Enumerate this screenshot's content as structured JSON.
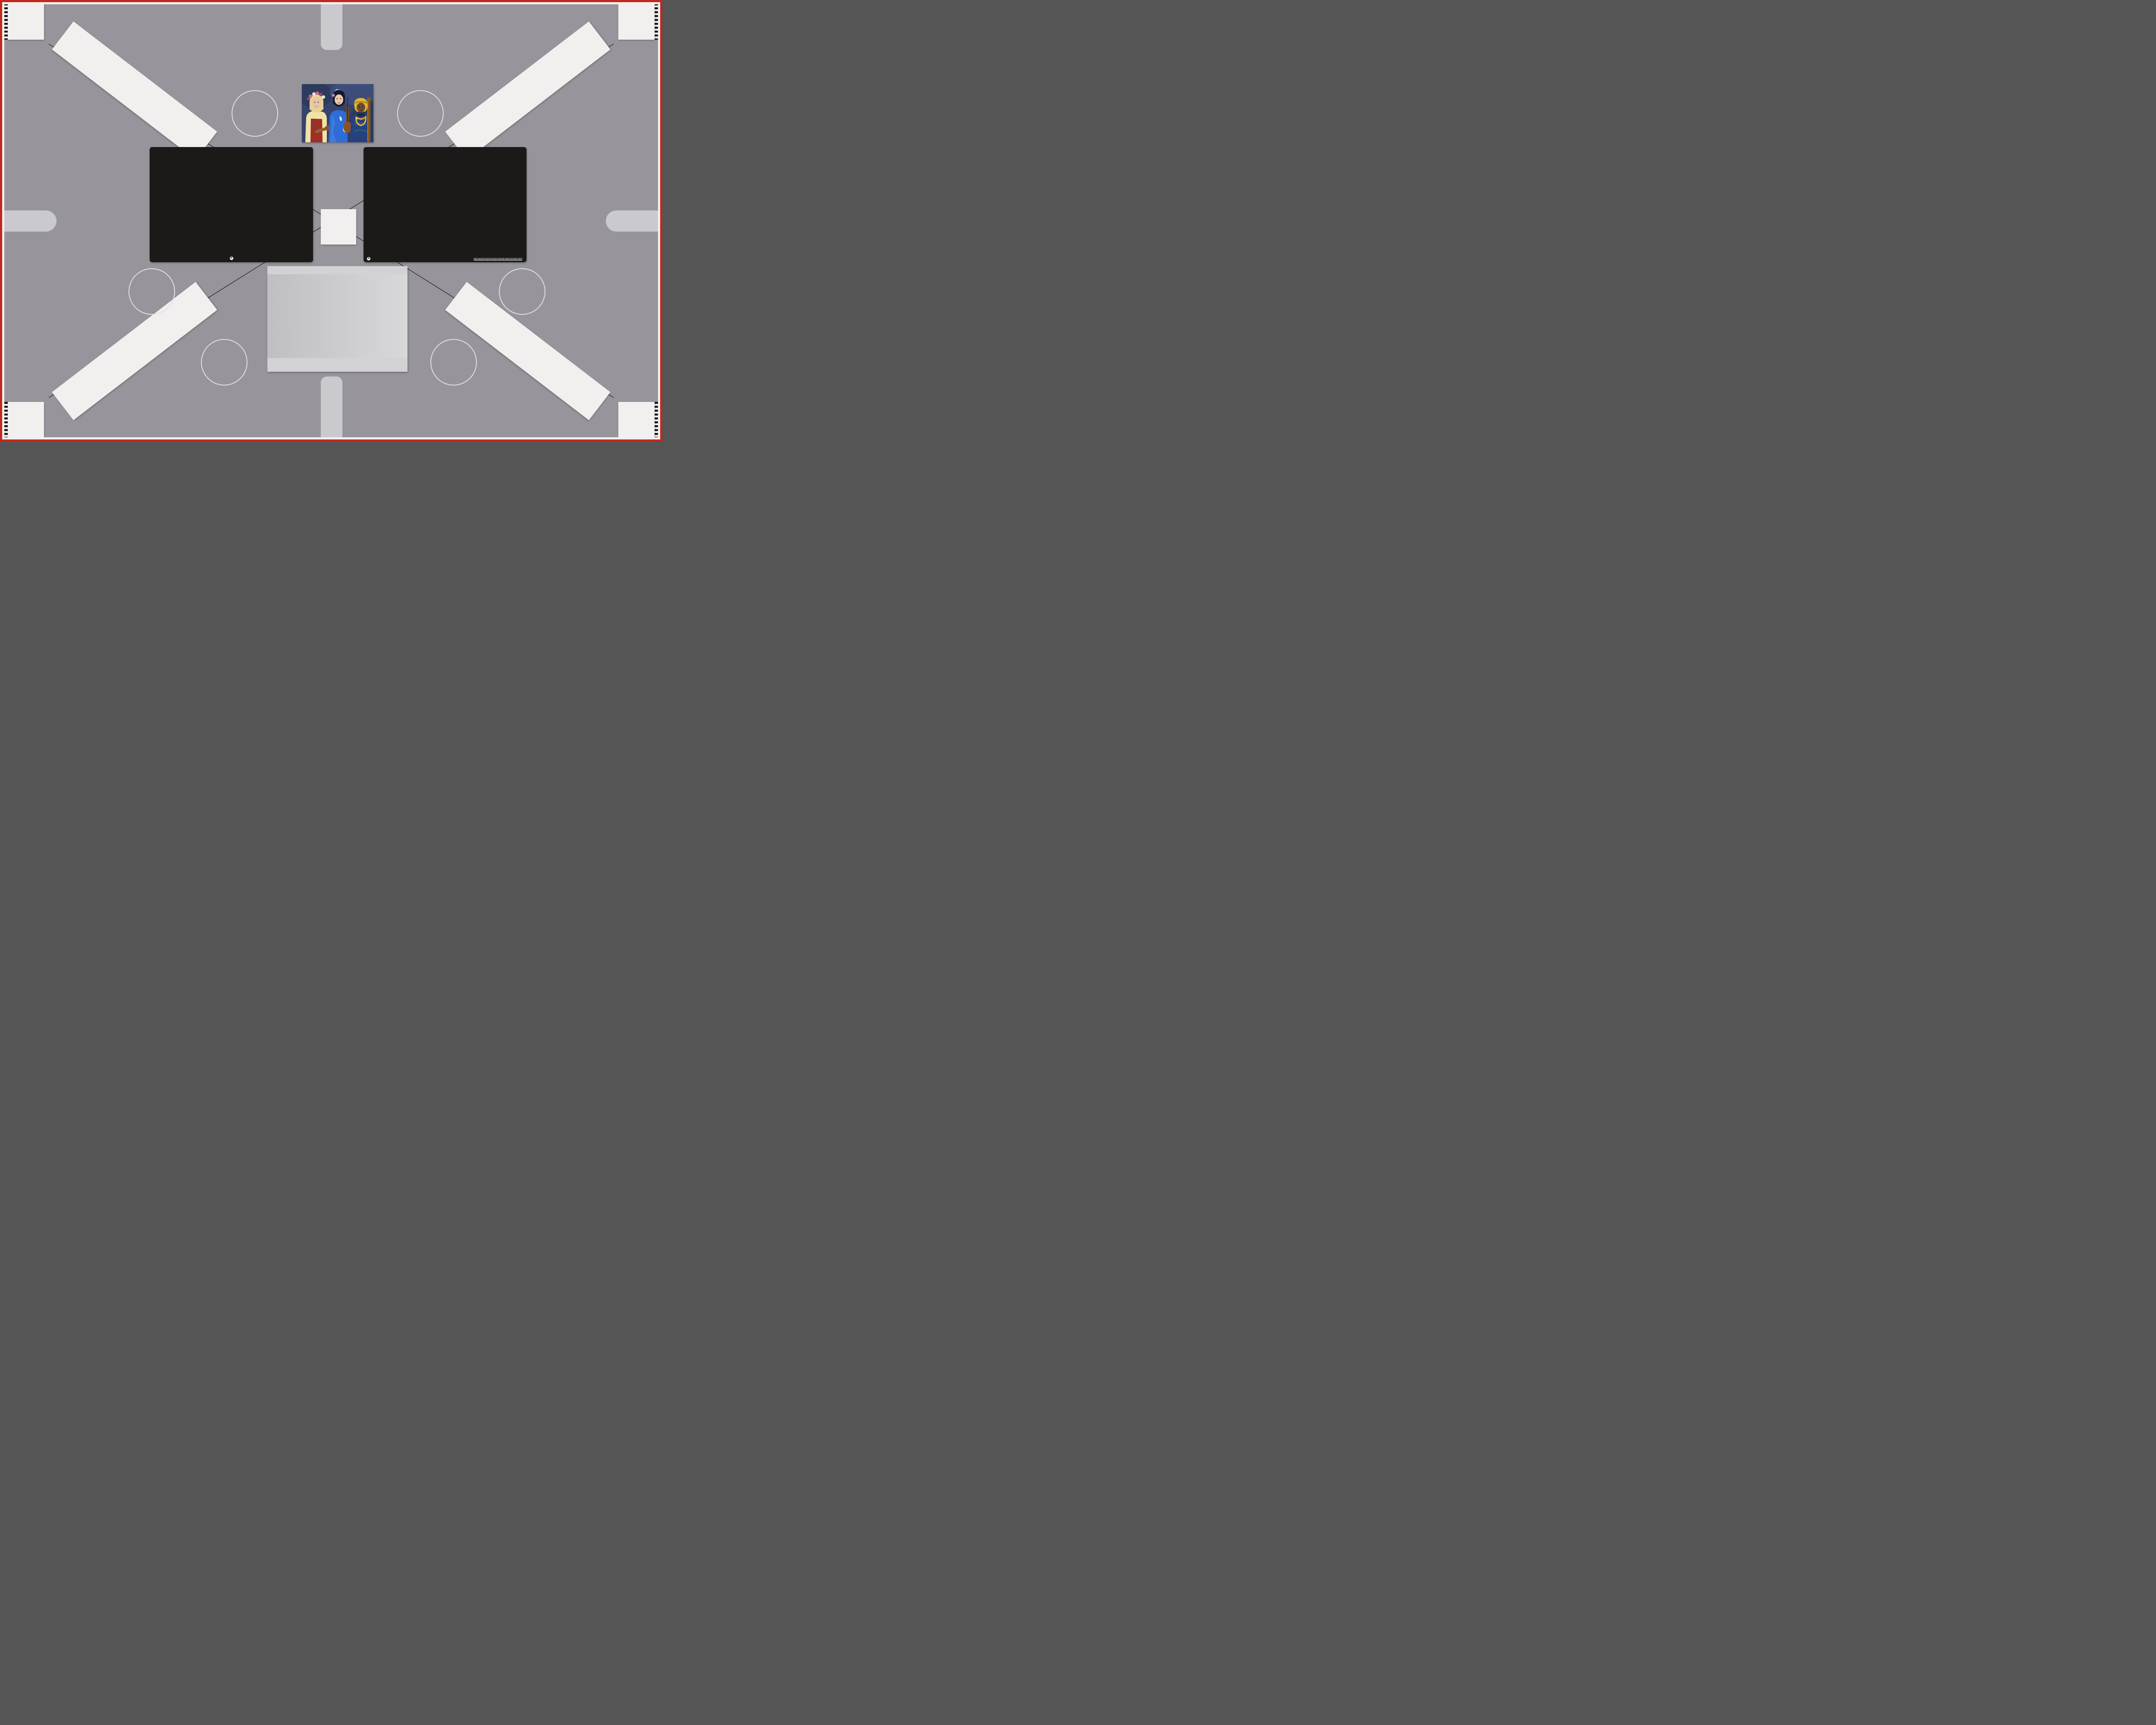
{
  "background": {
    "color": "#97959b",
    "border_red": "#c4281c",
    "border_white": "#f1f0ef",
    "frame_line_color": "#26262b",
    "pill_color": "#cacace"
  },
  "usaf": {
    "top_labels": [
      "-2",
      "-1"
    ],
    "left_numbers": [
      "2",
      "3",
      "4",
      "5",
      "6"
    ],
    "right_numbers": [
      "1",
      "2",
      "3",
      "4",
      "5",
      "6"
    ],
    "bottom_labels": [
      "-2",
      "1"
    ],
    "mini_labels": [
      "0",
      "1"
    ],
    "mini_numbers": [
      "2",
      "3",
      "4",
      "5",
      "6"
    ]
  },
  "colorchecker": {
    "label": "x-rite ColorChecker® Color Rendition Chart",
    "corner_mark": "+",
    "patches": [
      "#8a4b3b",
      "#dd9f88",
      "#5e86b7",
      "#4e6b2c",
      "#9792cf",
      "#63cec0",
      "#ef8d1d",
      "#4560d9",
      "#e05069",
      "#57297a",
      "#a6cb3a",
      "#efb421",
      "#2033ae",
      "#34a149",
      "#ce2a1f",
      "#e9d827",
      "#cd4ab1",
      "#1a99d1",
      "#f4f4f2",
      "#dbdcdb",
      "#b5b7b6",
      "#8f9392",
      "#575c5b",
      "#1d1d1d"
    ]
  },
  "sg": {
    "title": "Digital ColorChecker® SG",
    "logo": "x-rite",
    "corner_mark": "+",
    "row_labels": [
      "1",
      "2",
      "3",
      "4",
      "5",
      "6",
      "7",
      "8",
      "9",
      "10"
    ],
    "col_labels": [
      "A",
      "B",
      "C",
      "D",
      "E",
      "F",
      "G",
      "H",
      "I",
      "J",
      "K",
      "L",
      "M",
      "N"
    ],
    "ruler_labels": [
      "0",
      "1",
      "2",
      "3",
      "4",
      "5",
      "6"
    ],
    "ruler_unit": "mm",
    "patches": [
      [
        "#f2f2f0",
        "#a8a8a6",
        "#191917",
        "#f2f2f0",
        "#a8a8a6",
        "#191917",
        "#f2f2f0",
        "#a8a8a6",
        "#191917",
        "#f2f2f0",
        "#a8a8a6",
        "#191917",
        "#a8a8a6",
        "#f2f2f0"
      ],
      [
        "#191917",
        "#b62d74",
        "#3f2064",
        "#d8e0e4",
        "#8a4a2c",
        "#dba189",
        "#5c85b8",
        "#4c6a2a",
        "#8a82c8",
        "#64ccc0",
        "#f2dcc8",
        "#7c1432",
        "#da3064",
        "#8a8a88"
      ],
      [
        "#8a8a88",
        "#c888c8",
        "#8a6ac0",
        "#ecc8d8",
        "#e88a1e",
        "#4660d8",
        "#e05068",
        "#4c2080",
        "#a8c838",
        "#e8b820",
        "#c8e8d8",
        "#e03020",
        "#641430",
        "#191917"
      ],
      [
        "#f2f2f0",
        "#8a20a8",
        "#1a2470",
        "#b8e8d8",
        "#2438c0",
        "#28a048",
        "#d82820",
        "#e8d820",
        "#e048a8",
        "#28a8d8",
        "#e8e0ec",
        "#e888a8",
        "#d82838",
        "#f2f2f0"
      ],
      [
        "#191917",
        "#2888e8",
        "#48a8d8",
        "#f0d8d8",
        "#f2f2f0",
        "#c8c8c8",
        "#a8a8a8",
        "#8a8a8a",
        "#4a4a4a",
        "#2a2a2a",
        "#d8ecf0",
        "#e89080",
        "#e84820",
        "#8a8a88"
      ],
      [
        "#8a8a88",
        "#28b8d8",
        "#103048",
        "#d8e8b8",
        "#201c18",
        "#484848",
        "#6a6a6a",
        "#9a9a9a",
        "#c0c0c0",
        "#ececec",
        "#8a8a88",
        "#e87818",
        "#e8c818",
        "#191917"
      ],
      [
        "#f2f2f0",
        "#0c4038",
        "#88a8e0",
        "#e89058",
        "#e8b888",
        "#d8a878",
        "#c89868",
        "#d8a888",
        "#b86830",
        "#e8a888",
        "#c8c8c8",
        "#c8c818",
        "#e8d818",
        "#f2f2f0"
      ],
      [
        "#191917",
        "#28b8a8",
        "#189888",
        "#e89078",
        "#e8b8a0",
        "#e8a890",
        "#e8a088",
        "#e8a898",
        "#885028",
        "#e8b890",
        "#383838",
        "#b8a818",
        "#a8b828",
        "#8a8a88"
      ],
      [
        "#8a8a88",
        "#403818",
        "#48c888",
        "#18a858",
        "#084828",
        "#28b888",
        "#88d8a8",
        "#28a828",
        "#18c838",
        "#a8c828",
        "#d8a818",
        "#98c818",
        "#581c28",
        "#191917"
      ],
      [
        "#f2f2f0",
        "#a8a8a6",
        "#191917",
        "#f2f2f0",
        "#a8a8a6",
        "#191917",
        "#f2f2f0",
        "#a8a8a6",
        "#191917",
        "#f2f2f0",
        "#a8a8a6",
        "#191917",
        "#a8a8a6",
        "#f2f2f0"
      ]
    ]
  },
  "stars": {
    "red": {
      "color_a": "#c93a1f",
      "color_b": "#2a100b"
    },
    "green": {
      "color_a": "#35b85e",
      "color_b": "#0c2712"
    },
    "gold": {
      "color_a": "#d8491f",
      "color_b": "#3db55c"
    },
    "blue": {
      "color_a": "#3b50cc",
      "color_b": "#12122b"
    },
    "teal": {
      "color_a": "#33b06c",
      "color_b": "#2e52c9"
    },
    "magenta": {
      "color_a": "#e03e2a",
      "color_b": "#4950d3"
    }
  },
  "grayscale_chart": {
    "wedge_steps": [
      "#141414",
      "#f1f1f1",
      "#e7e7e7",
      "#dddddd",
      "#d3d3d3",
      "#c8c8c8",
      "#bdbdbd",
      "#b2b2b2",
      "#a7a7a7",
      "#9b9b9b",
      "#8f8f8f",
      "#828282",
      "#757575",
      "#686868",
      "#5a5a5a",
      "#4c4c4c",
      "#3e3d3d",
      "#2e2d2d",
      "#e9e9e9",
      "#141414"
    ]
  },
  "photo": {
    "bg": "#36436b",
    "palette": {
      "skin_light": "#e9c3a6",
      "skin_dark": "#6f4a33",
      "blonde": "#e7d193",
      "vest_red": "#9c2f26",
      "blouse_yellow": "#f0e3a8",
      "kimono_blue": "#2e6cd6",
      "hair_black": "#17182a",
      "turban_yellow": "#e2b52f",
      "robe_blue": "#27407e",
      "violin_brown": "#9a5f2c",
      "cello_orange": "#c07c1e"
    }
  }
}
